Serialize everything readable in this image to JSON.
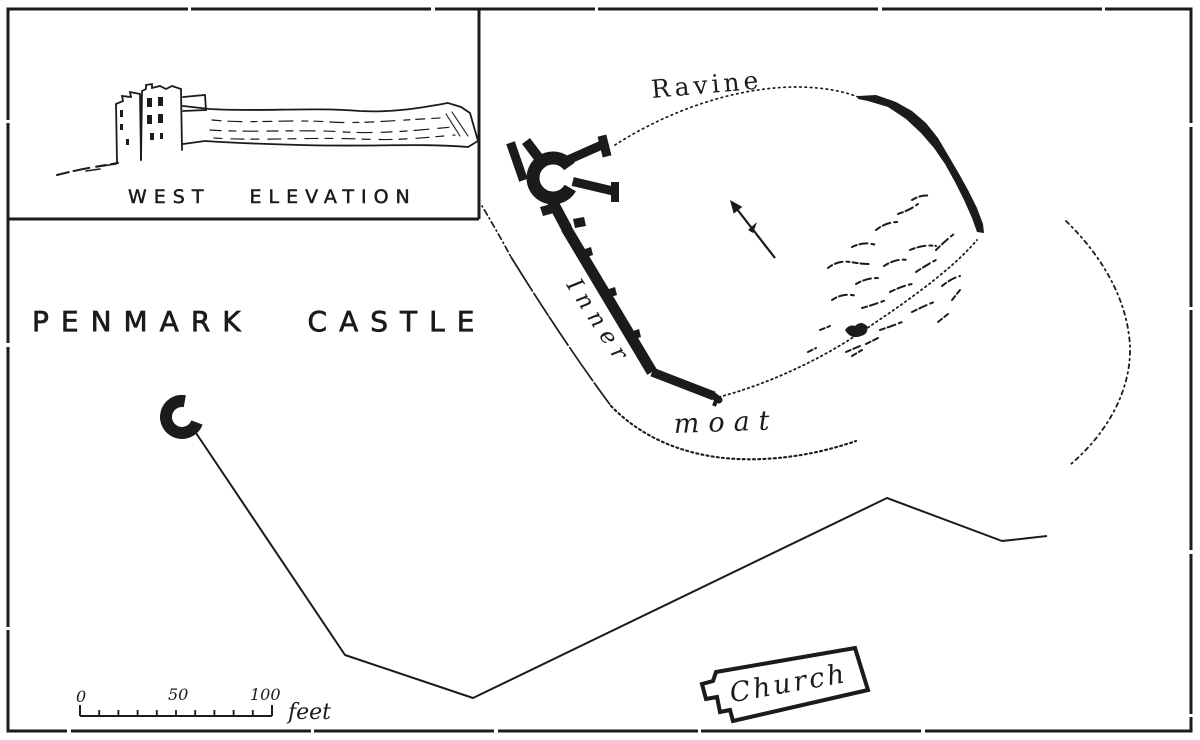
{
  "colors": {
    "ink": "#1b1b1b",
    "paper": "#ffffff"
  },
  "inset": {
    "caption": "WEST ELEVATION"
  },
  "title": "PENMARK CASTLE",
  "map_labels": {
    "ravine": "Ravine",
    "inner": "Inner",
    "moat": "moat",
    "church": "Church"
  },
  "scale_bar": {
    "zero": "0",
    "fifty": "50",
    "hundred": "100",
    "unit": "feet"
  },
  "icons": {
    "compass": "north-arrow"
  }
}
